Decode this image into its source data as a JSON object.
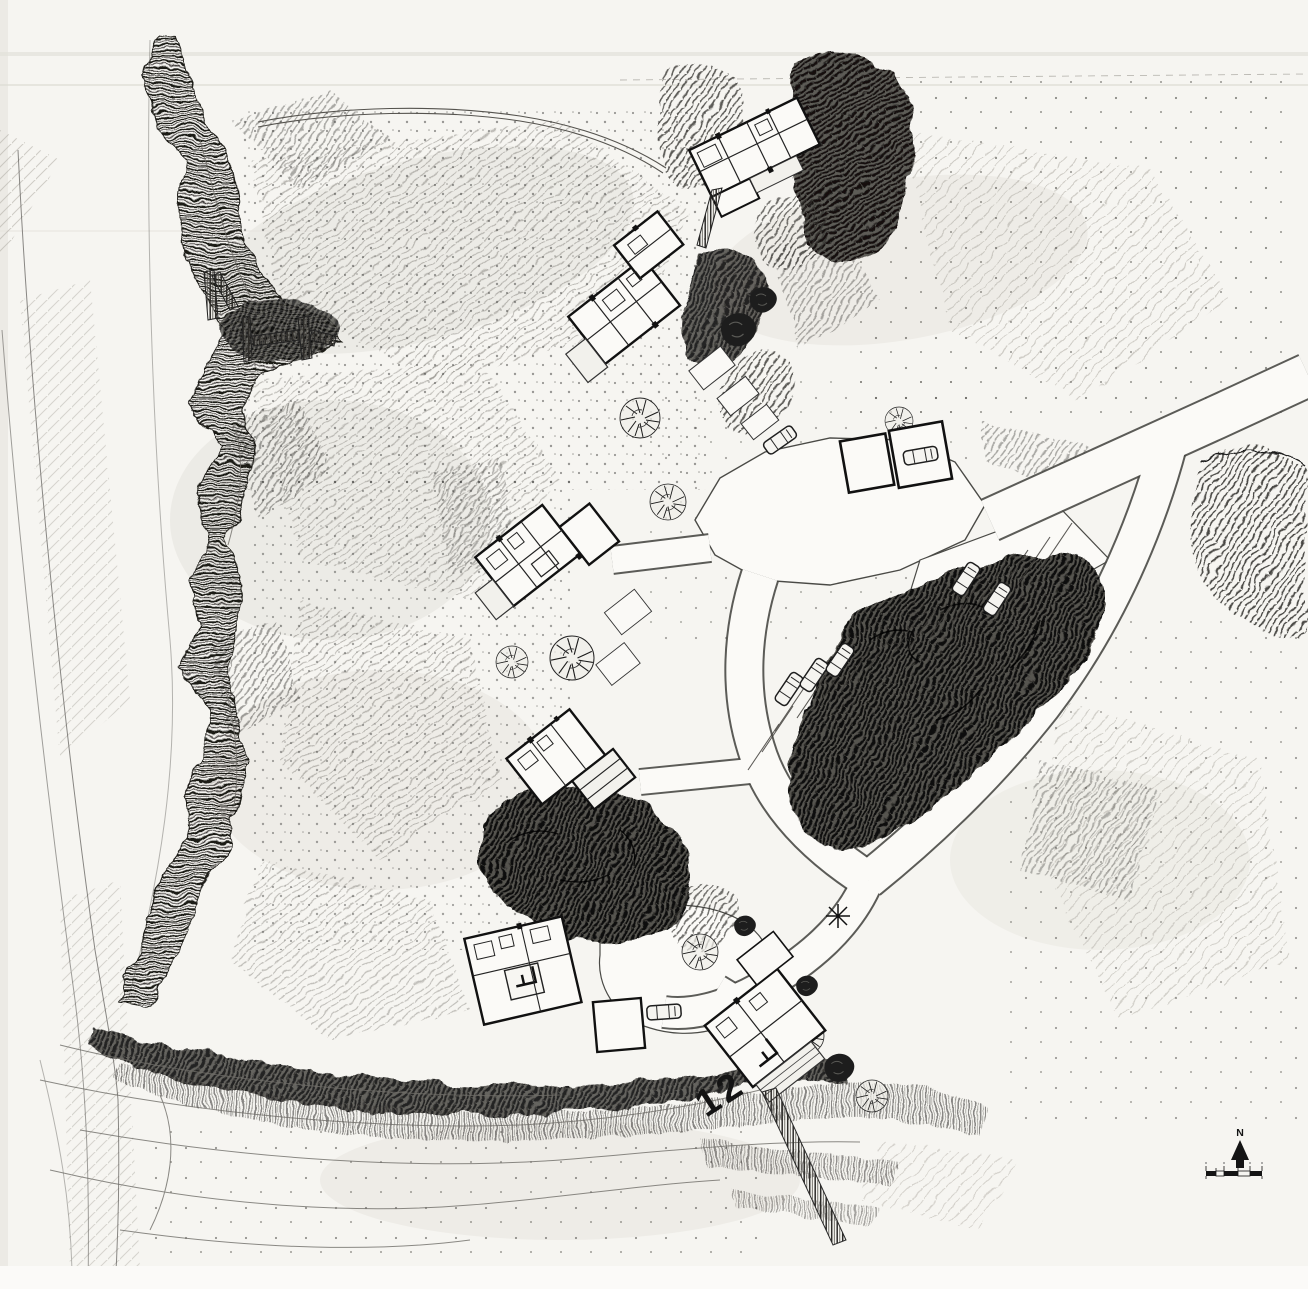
{
  "plan": {
    "figure_label": "12",
    "compass": {
      "north_letter": "N"
    },
    "colors": {
      "paper": "#f6f5f1",
      "ink": "#141414",
      "pencil": "#8f8d88",
      "vegetation_dark": "#1d1d1d"
    }
  }
}
